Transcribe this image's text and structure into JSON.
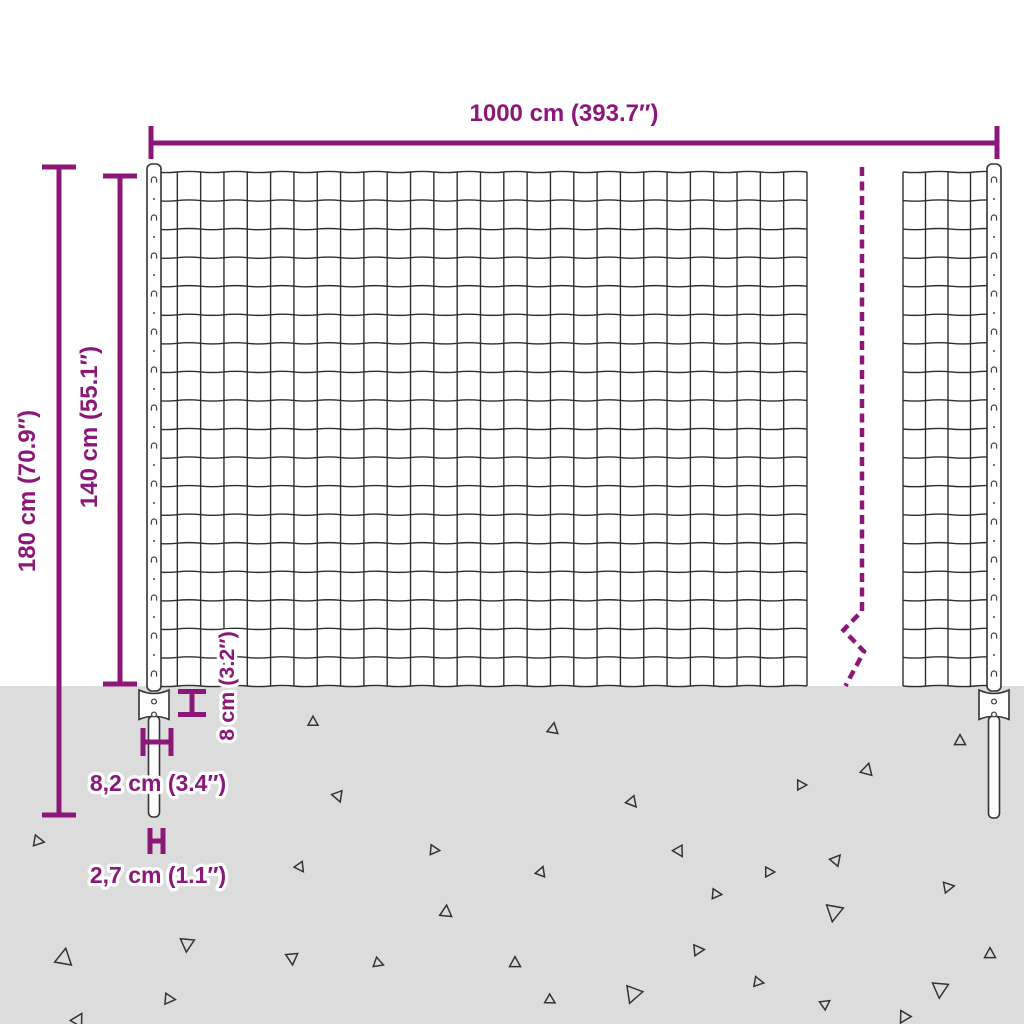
{
  "diagram": {
    "kind": "product-dimension-diagram",
    "subject": "wire-mesh-fence-panel-with-posts"
  },
  "colors": {
    "accent": "#8b1879",
    "ground": "#dcdcdc",
    "wire": "#2f2f2f",
    "background": "#ffffff"
  },
  "labels": {
    "width": "1000 cm (393.7″)",
    "total_height": "180 cm (70.9″)",
    "mesh_height": "140 cm (55.1″)",
    "anchor_depth": "8 cm (3.2″)",
    "anchor_width": "8,2 cm (3.4″)",
    "spike_width": "2,7 cm (1.1″)"
  },
  "ground": {
    "triangles": [
      {
        "x": 313,
        "y": 722,
        "s": 10,
        "r": 0
      },
      {
        "x": 553,
        "y": 729,
        "s": 11,
        "r": 10
      },
      {
        "x": 960,
        "y": 741,
        "s": 11,
        "r": 0
      },
      {
        "x": 867,
        "y": 770,
        "s": 12,
        "r": 15
      },
      {
        "x": 801,
        "y": 785,
        "s": 10,
        "r": 90
      },
      {
        "x": 338,
        "y": 796,
        "s": 11,
        "r": 160
      },
      {
        "x": 632,
        "y": 802,
        "s": 11,
        "r": 140
      },
      {
        "x": 38,
        "y": 841,
        "s": 11,
        "r": 100
      },
      {
        "x": 434,
        "y": 850,
        "s": 10,
        "r": 95
      },
      {
        "x": 679,
        "y": 851,
        "s": 11,
        "r": 150
      },
      {
        "x": 836,
        "y": 860,
        "s": 11,
        "r": 40
      },
      {
        "x": 300,
        "y": 867,
        "s": 10,
        "r": 145
      },
      {
        "x": 541,
        "y": 872,
        "s": 10,
        "r": 20
      },
      {
        "x": 769,
        "y": 872,
        "s": 10,
        "r": 90
      },
      {
        "x": 948,
        "y": 887,
        "s": 11,
        "r": 80
      },
      {
        "x": 716,
        "y": 894,
        "s": 10,
        "r": 95
      },
      {
        "x": 446,
        "y": 912,
        "s": 12,
        "r": 5
      },
      {
        "x": 834,
        "y": 912,
        "s": 17,
        "r": 190
      },
      {
        "x": 187,
        "y": 944,
        "s": 14,
        "r": 185
      },
      {
        "x": 64,
        "y": 958,
        "s": 17,
        "r": 10
      },
      {
        "x": 990,
        "y": 954,
        "s": 11,
        "r": 0
      },
      {
        "x": 698,
        "y": 950,
        "s": 11,
        "r": 85
      },
      {
        "x": 515,
        "y": 963,
        "s": 11,
        "r": 0
      },
      {
        "x": 378,
        "y": 963,
        "s": 10,
        "r": 110
      },
      {
        "x": 292,
        "y": 958,
        "s": 12,
        "r": 175
      },
      {
        "x": 758,
        "y": 982,
        "s": 10,
        "r": 100
      },
      {
        "x": 633,
        "y": 994,
        "s": 17,
        "r": 200
      },
      {
        "x": 550,
        "y": 1000,
        "s": 10,
        "r": 120
      },
      {
        "x": 169,
        "y": 999,
        "s": 11,
        "r": 95
      },
      {
        "x": 825,
        "y": 1004,
        "s": 10,
        "r": 55
      },
      {
        "x": 940,
        "y": 989,
        "s": 16,
        "r": 185
      },
      {
        "x": 904,
        "y": 1017,
        "s": 12,
        "r": 210
      },
      {
        "x": 78,
        "y": 1020,
        "s": 13,
        "r": 30
      }
    ]
  }
}
